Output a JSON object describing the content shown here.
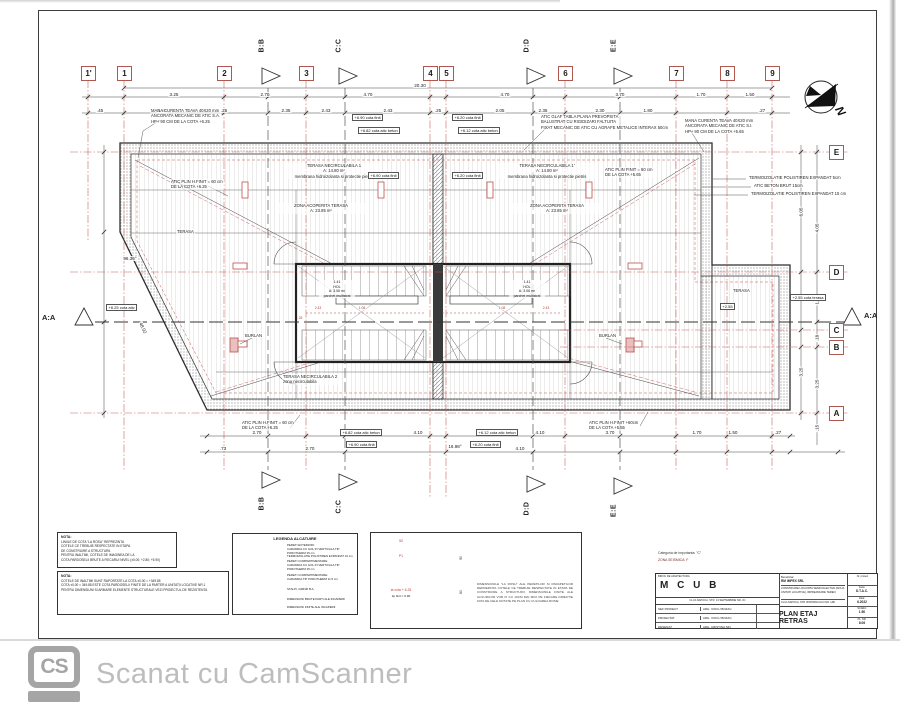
{
  "page": {
    "footer_logo": "CS",
    "footer_text": "Scanat cu CamScanner"
  },
  "grid": {
    "top": [
      "1'",
      "1",
      "2",
      "3",
      "4",
      "5",
      "6",
      "7",
      "8",
      "9"
    ],
    "right": [
      "E",
      "D",
      "C",
      "B",
      "A"
    ],
    "sections": [
      "B:B",
      "C:C",
      "D:D",
      "E:E"
    ],
    "axis": "A:A",
    "north": "N"
  },
  "dims": {
    "overall": "20.30",
    "t1": [
      "3.25",
      "2.70",
      "4.70",
      "4.70",
      "3.70",
      "1.70",
      "1.50"
    ],
    "t2": [
      ".45",
      "2.30",
      ".25",
      "2.35",
      "2.43",
      "2.43",
      ".25",
      "2.05",
      "2.35",
      "2.30",
      "1.80",
      ".27"
    ],
    "b1": [
      "2.70",
      "4.10",
      "4.10",
      "3.70",
      "1.70",
      "1.50",
      ".27"
    ],
    "b2": [
      ".73",
      "2.70",
      "4.10"
    ],
    "r": [
      "6.05",
      "4.05",
      "1.93",
      "3.25",
      ".18",
      "3.25",
      ".15"
    ],
    "angle_left": "96.36°",
    "angle_bottom": "16.98°",
    "diag": "48.02"
  },
  "ann": [
    "MANA CURENTA TEAVA 40X20 mm\nANCORATA MECANIC DE ATIC S.A.\nHP+ 90 CM DE LA COTA +6.25",
    "ATIC GLAF TABLA PLANA PREVOPSITA\nBALUSTRAT CU RIGIDIZARI FALTUITA\nFIXAT MECANIC DE ATIC CU AGRAFE METALICE INTERAX 50cm",
    "MANA CURENTA TEAVA 40X20 mm\nANCORATA MECANIC DE ATIC S.I.\nHP+ 90 CM DE LA COTA +5.65",
    "TERMOIZOLATIE POLISTIREN EXPANDAT 5cm",
    "ATIC BETON BRUT 15cm",
    "TERMOIZOLATIE POLISTIREN EXPANDAT 15 cm",
    "ATIC PLIN H.FINIT = 60 cm\nDE LA COTA +6.25",
    "ATIC PLIN FINIT = 60 cm\nDE LA COTA +5.65",
    "TERASA NECIRCULABILA 1\nA: 14.80 m²\nmembrana hidroizolanta si protectie pietris",
    "TERASA NECIRCULABILA 1'\nA: 14.80 m²\nmembrana hidroizolanta si protectie pietris",
    "ZONA ACOPERITA TERASA\nA: 23.85 m²",
    "ZONA ACOPERITA TERASA\nA: 23.85 m²",
    "TERASA",
    "TERASA",
    "ATIC PLIN H.FINIT = 60 cm\nDE LA COTA +6.25",
    "ATIC PLIN H.FINIT +60cm\nDE LA COTA +5.55",
    "BURLAN",
    "BURLAN",
    "TERASA NECIRCULABILA 2\nzona necirculabila"
  ],
  "cotas": [
    "+6.90 cota finit",
    "+6.82 cota atic beton",
    "+6.20 cota finit",
    "+6.12 cota atic beton",
    "+6.90 cota finit",
    "+6.20 cota finit",
    "+6.82 cota atic beton",
    "+6.90 cota finit",
    "+6.12 cota atic beton",
    "+6.20 cota finit",
    "+2.55",
    "+2.55 cota terasa",
    "+6.25 cota atic"
  ],
  "core": {
    "room_left": "1.41\nHOL\nA: 3.06 m²\nparchet multistrat",
    "room_right": "1.41\nHOL\nA: 3.06 m²\nparchet multistrat",
    "dims": [
      "2.43",
      "1.08",
      ".25",
      "1.08",
      "2.43"
    ]
  },
  "notes": {
    "nota1_title": "NOTA:",
    "nota1": "LINIILE DE COTA \"LA ROSU\" REPREZINTA\nCOTELE CE TREBUIE RESPECTATE IN ETAPA\nDE CONSTRUIRE A STRUCTURII.\nPENTRU INALTIMI, COTELE DE IMAGINEA DE LA\nCOTA PARDOSELII BRUTE A FIECARUI NIVEL (±0.00; +2.80; +5.90)",
    "nota2_title": "NOTA:",
    "nota2": "COTELE DE INALTIMI SUNT RAPORTATE LA COTA ±0.00 = +349.85\nCOTA ±0.00 = 349.85 ESTE COTA PARDOSELII FINITE DE LA PARTER A UNITATII LOCATIVE NR.1\nPENTRU DIMENSIUNI SI ARMARE ELEMENTE STRUCTURALE VEZI PROIECTUL DE REZISTENTA"
  },
  "legend": {
    "title": "LEGENDA ALCATUIRE",
    "entries": [
      "PERETI EXTERIORI:\nCARAMIDA CU GOL IN VERTICALA TIP POROTHERM 25 cm\nTERMOIZOLATIE POLISTIREN EXPANDAT 10 cm",
      "PERETI COMPARTIMENTARE:\nCARAMIDA CU GOL IN VERTICALA TIP POROTHERM 25 cm",
      "PERETI COMPARTIMENTARE:\nCARAMIDA TIP POROTHERM 11.5 cm",
      "STALPI, GRINZI B.A.",
      "DIMENSIUNI BRUTE PARTI ALE INCAPERII",
      "DIMENSIUNI FINITE ALE INCAPERII"
    ]
  },
  "detail": {
    "text": "DIMENSIUNILE \"LA ROSU\" ALE PERETILOR SI PARAPETILOR REPREZINTA COTELE CE TREBUIE RESPECTATE IN ETAPA DE CONSTRUIRE A STRUCTURII. DIMENSIUNILE FINITE ALE GOLURILOR VOR FI CU 10CM MAI MICI PE FIECARE DIRECTIE FATA DE CELE NOTATE PE PLAN CU CULOAREA ROSIE",
    "p1": "P1",
    "d50": "50",
    "d90": "90",
    "d60": "60",
    "cota_red": "la cota + 6.25",
    "cota_fin": "tip finit = 6.90"
  },
  "title_block": {
    "importance": "Categoria de importanta: \"C\"",
    "seismic": "ZONA SEISMICA: F",
    "office_header": "BIROU DE ARHITECTURA",
    "office_name": "M C U B",
    "office_address": "CLUJ-NAPOCA, STR. 13 SEPTEMBRIE NR. 3C",
    "rows": [
      {
        "role": "SEF PROIECT",
        "name": "ARH. VOICU BOZAC"
      },
      {
        "role": "PROIECTAT",
        "name": "ARH. VOICU BOZAC"
      },
      {
        "role": "DESENAT",
        "name": "ARH. CRISTINA SIN"
      }
    ],
    "beneficiary_label": "Beneficiar:",
    "beneficiary": "RM IMPEX SRL",
    "project": "CONSTRUIRE LOCUINTA SEMICOLECTIVA (DOUA UNITATI LOCATIVE), IMPREJMUIRE TEREN",
    "address": "CLUJ-NAPOCA, STR. BORHANCULUI NR. 14B",
    "sheet_title": "PLAN ETAJ RETRAS",
    "meta": [
      {
        "k": "Nr. proiect",
        "v": ""
      },
      {
        "k": "Faza:",
        "v": "D.T.A.C."
      },
      {
        "k": "Data:",
        "v": "6.2022"
      },
      {
        "k": "SCARA:",
        "v": "1:50"
      },
      {
        "k": "PL. NR.",
        "v": "8.06"
      }
    ]
  }
}
